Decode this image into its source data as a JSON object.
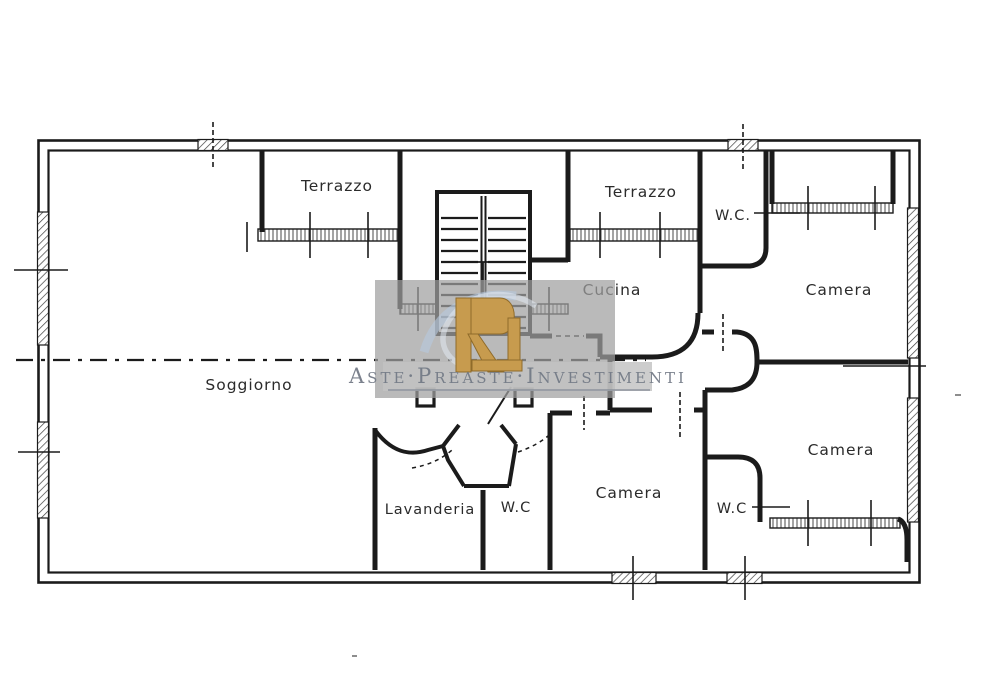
{
  "document": {
    "kind": "scanned apartment floor plan"
  },
  "rooms": {
    "terrazzo_left": "Terrazzo",
    "terrazzo_right": "Terrazzo",
    "wc_top": "W.C.",
    "cucina": "Cucina",
    "camera_top_right": "Camera",
    "soggiorno": "Soggiorno",
    "camera_bottom_right": "Camera",
    "camera_bottom_center": "Camera",
    "lavanderia": "Lavanderia",
    "wc_center": "W.C",
    "wc_bottom": "W.C"
  },
  "watermark": {
    "brand_text": "Aste·Preaste·Investimenti",
    "logo_icon": "monogram-r-icon",
    "panel_color": "#b5b5b5",
    "logo_gold": "#c79b4e",
    "swoosh_blue": "#b8cadf",
    "text_color": "#747b87"
  },
  "colors": {
    "ink": "#1b1b1b",
    "paper": "#ffffff"
  }
}
